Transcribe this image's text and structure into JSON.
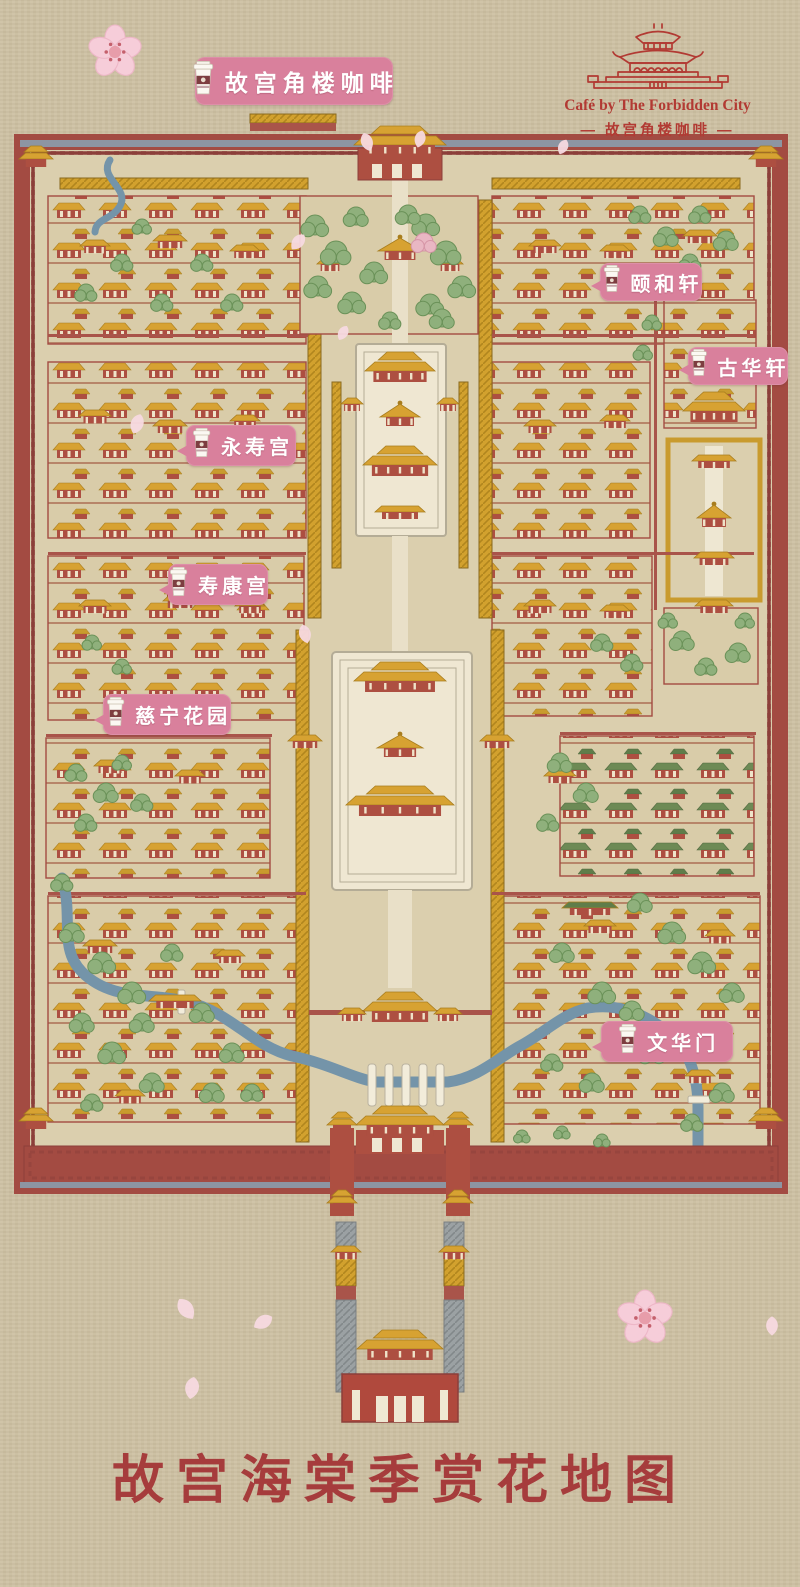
{
  "banner": {
    "label": "故宫角楼咖啡",
    "x": 195,
    "y": 57,
    "w": 198,
    "h": 48
  },
  "logo": {
    "en": "Café by The Forbidden City",
    "zh": "— 故宫角楼咖啡 —",
    "color": "#b23a33"
  },
  "title": "故宫海棠季赏花地图",
  "map": {
    "colors": {
      "paper": "#cdc0a2",
      "ground": "#dbcfae",
      "block": "#d9cca9",
      "wall": "#a34b42",
      "wallDark": "#8c3f3a",
      "trim": "#8d95a2",
      "roof": "#d7a232",
      "roofDark": "#a87d1e",
      "red": "#ad4f41",
      "marble": "#efe7d2",
      "marbleLine": "#b4ac96",
      "river": "#7494a9",
      "tree": "#8fb07c",
      "treeDark": "#6a9158",
      "pink": "#d9809c",
      "greenRoof": "#5f7d4a"
    },
    "labels": [
      {
        "id": "yihexuan",
        "text": "颐和轩",
        "x": 600,
        "y": 263,
        "w": 102,
        "h": 38
      },
      {
        "id": "guhuaxuan",
        "text": "古华轩",
        "x": 688,
        "y": 347,
        "w": 100,
        "h": 38
      },
      {
        "id": "yongshougong",
        "text": "永寿宫",
        "x": 186,
        "y": 425,
        "w": 110,
        "h": 41
      },
      {
        "id": "shoukanggong",
        "text": "寿康宫",
        "x": 168,
        "y": 564,
        "w": 100,
        "h": 41
      },
      {
        "id": "cininghuayuan",
        "text": "慈宁花园",
        "x": 103,
        "y": 694,
        "w": 128,
        "h": 41
      },
      {
        "id": "wenhuamen",
        "text": "文华门",
        "x": 601,
        "y": 1021,
        "w": 132,
        "h": 41
      }
    ],
    "art": {
      "blocks": [
        [
          48,
          196,
          258,
          148
        ],
        [
          48,
          362,
          258,
          176
        ],
        [
          48,
          556,
          256,
          164
        ],
        [
          46,
          738,
          224,
          140
        ],
        [
          48,
          896,
          256,
          226
        ],
        [
          492,
          196,
          262,
          148
        ],
        [
          492,
          362,
          158,
          176
        ],
        [
          664,
          300,
          92,
          128
        ],
        [
          492,
          556,
          160,
          160
        ],
        [
          560,
          736,
          194,
          140,
          "green"
        ],
        [
          492,
          896,
          268,
          228
        ]
      ],
      "galleries": [
        [
          60,
          178,
          248,
          11
        ],
        [
          492,
          178,
          248,
          11
        ],
        [
          308,
          200,
          13,
          418
        ],
        [
          479,
          200,
          13,
          418
        ],
        [
          332,
          382,
          9,
          186
        ],
        [
          459,
          382,
          9,
          186
        ],
        [
          296,
          630,
          13,
          512
        ],
        [
          491,
          630,
          13,
          512
        ]
      ],
      "redwalls": [
        [
          48,
          334,
          260,
          3
        ],
        [
          492,
          334,
          262,
          3
        ],
        [
          48,
          552,
          258,
          3
        ],
        [
          492,
          552,
          262,
          3
        ],
        [
          46,
          734,
          226,
          3
        ],
        [
          560,
          732,
          196,
          3
        ],
        [
          48,
          892,
          258,
          3
        ],
        [
          492,
          892,
          268,
          3
        ],
        [
          309,
          1010,
          56,
          5
        ],
        [
          436,
          1010,
          56,
          5
        ],
        [
          654,
          300,
          3,
          310
        ]
      ],
      "pavilions": [
        [
          95,
          240,
          30
        ],
        [
          170,
          235,
          34
        ],
        [
          245,
          245,
          30
        ],
        [
          545,
          240,
          32
        ],
        [
          615,
          245,
          30
        ],
        [
          700,
          230,
          34
        ],
        [
          95,
          410,
          32
        ],
        [
          170,
          420,
          34
        ],
        [
          245,
          415,
          30
        ],
        [
          540,
          420,
          32
        ],
        [
          615,
          415,
          30
        ],
        [
          95,
          600,
          32
        ],
        [
          180,
          595,
          34
        ],
        [
          250,
          600,
          30
        ],
        [
          540,
          600,
          32
        ],
        [
          615,
          605,
          30
        ],
        [
          110,
          760,
          32
        ],
        [
          190,
          770,
          30
        ],
        [
          560,
          770,
          32
        ],
        [
          100,
          940,
          34
        ],
        [
          230,
          950,
          30
        ],
        [
          175,
          995,
          52
        ],
        [
          600,
          920,
          32
        ],
        [
          720,
          930,
          30
        ],
        [
          130,
          1090,
          30
        ],
        [
          700,
          1070,
          30
        ]
      ],
      "trees": [
        [
          315,
          225,
          10
        ],
        [
          336,
          252,
          11
        ],
        [
          318,
          286,
          10
        ],
        [
          352,
          302,
          10
        ],
        [
          356,
          216,
          9
        ],
        [
          374,
          272,
          10
        ],
        [
          426,
          224,
          10
        ],
        [
          446,
          252,
          11
        ],
        [
          462,
          286,
          10
        ],
        [
          430,
          304,
          10
        ],
        [
          408,
          214,
          9
        ],
        [
          442,
          318,
          9
        ],
        [
          390,
          320,
          8
        ],
        [
          640,
          214,
          8
        ],
        [
          666,
          236,
          9
        ],
        [
          700,
          214,
          8
        ],
        [
          726,
          240,
          9
        ],
        [
          690,
          262,
          8
        ],
        [
          682,
          640,
          9
        ],
        [
          738,
          652,
          9
        ],
        [
          706,
          666,
          8
        ],
        [
          668,
          620,
          7
        ],
        [
          745,
          620,
          7
        ],
        [
          652,
          322,
          7
        ],
        [
          643,
          352,
          7
        ],
        [
          602,
          642,
          8
        ],
        [
          632,
          662,
          8
        ],
        [
          560,
          762,
          9
        ],
        [
          586,
          792,
          9
        ],
        [
          548,
          822,
          8
        ],
        [
          640,
          902,
          9
        ],
        [
          672,
          932,
          10
        ],
        [
          702,
          962,
          10
        ],
        [
          732,
          992,
          9
        ],
        [
          562,
          952,
          9
        ],
        [
          602,
          992,
          10
        ],
        [
          652,
          1052,
          10
        ],
        [
          722,
          1092,
          9
        ],
        [
          692,
          1122,
          8
        ],
        [
          592,
          1082,
          9
        ],
        [
          552,
          1062,
          8
        ],
        [
          632,
          1010,
          9
        ],
        [
          700,
          1030,
          8
        ],
        [
          72,
          932,
          9
        ],
        [
          102,
          962,
          10
        ],
        [
          132,
          992,
          10
        ],
        [
          82,
          1022,
          9
        ],
        [
          112,
          1052,
          10
        ],
        [
          152,
          1082,
          9
        ],
        [
          92,
          1102,
          8
        ],
        [
          202,
          1012,
          9
        ],
        [
          232,
          1052,
          9
        ],
        [
          172,
          952,
          8
        ],
        [
          252,
          1092,
          8
        ],
        [
          62,
          882,
          8
        ],
        [
          142,
          1022,
          9
        ],
        [
          212,
          1092,
          9
        ],
        [
          76,
          772,
          8
        ],
        [
          106,
          792,
          9
        ],
        [
          86,
          822,
          8
        ],
        [
          142,
          802,
          8
        ],
        [
          122,
          762,
          7
        ],
        [
          86,
          292,
          8
        ],
        [
          122,
          262,
          8
        ],
        [
          162,
          302,
          8
        ],
        [
          202,
          262,
          8
        ],
        [
          232,
          302,
          8
        ],
        [
          142,
          226,
          7
        ],
        [
          92,
          642,
          7
        ],
        [
          122,
          666,
          7
        ],
        [
          562,
          1132,
          6
        ],
        [
          602,
          1140,
          6
        ],
        [
          522,
          1136,
          6
        ],
        [
          424,
          242,
          9,
          "pink"
        ]
      ],
      "petals": [
        [
          367,
          142,
          -20,
          1.2
        ],
        [
          420,
          139,
          15,
          1.1
        ],
        [
          563,
          147,
          25,
          1.0
        ],
        [
          298,
          242,
          40,
          1.2
        ],
        [
          343,
          333,
          30,
          1.0
        ],
        [
          305,
          634,
          -15,
          1.2
        ],
        [
          137,
          424,
          20,
          1.3
        ],
        [
          186,
          1309,
          -35,
          1.5
        ],
        [
          192,
          1388,
          10,
          1.4
        ],
        [
          263,
          1322,
          60,
          1.3
        ],
        [
          772,
          1326,
          0,
          1.2
        ]
      ],
      "flowers": [
        [
          115,
          52,
          1.35
        ],
        [
          645,
          1318,
          1.4
        ]
      ]
    }
  }
}
